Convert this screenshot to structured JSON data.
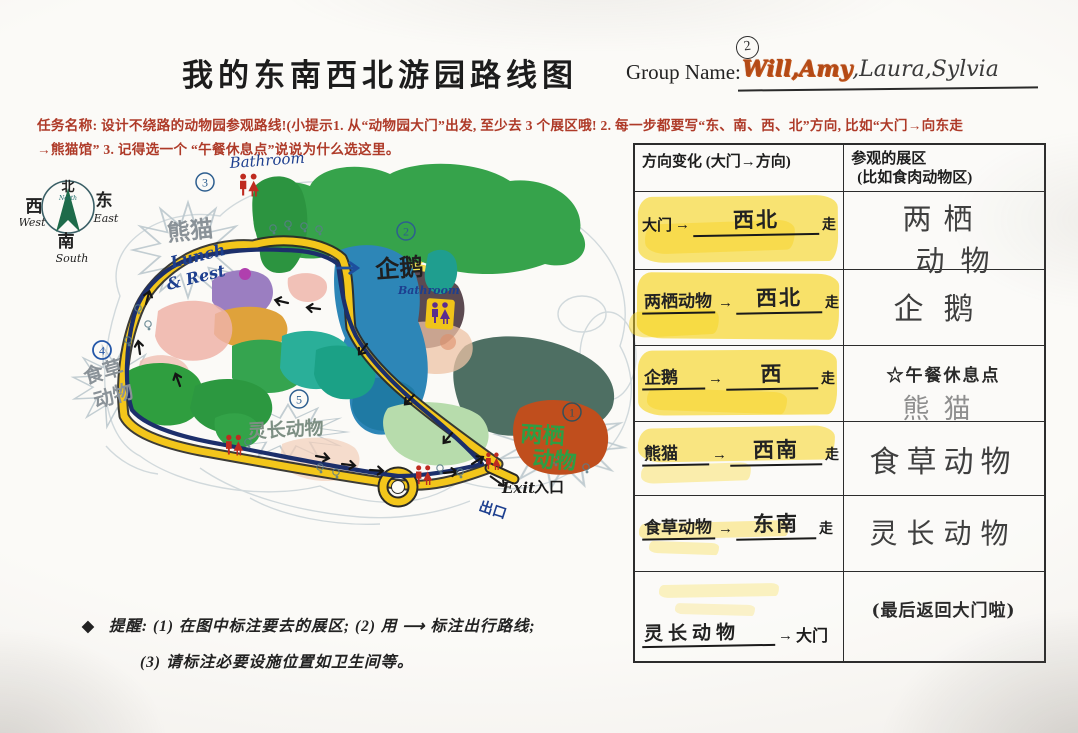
{
  "header": {
    "title": "我的东南西北游园路线图",
    "group_label": "Group Name:",
    "group_number": "2",
    "names_highlighted": "Will,Amy",
    "names_rest": ",Laura,Sylvia"
  },
  "task": {
    "line1": "任务名称: 设计不绕路的动物园参观路线!(小提示1. 从“动物园大门”出发, 至少去 3 个展区哦! 2.  每一步都要写“东、南、西、北”方向, 比如“大门→向东走",
    "line2": "→熊猫馆” 3. 记得选一个 “午餐休息点”说说为什么选这里。"
  },
  "map": {
    "compass": {
      "north": "北",
      "north_en": "North",
      "west": "西",
      "west_en": "West",
      "east": "东",
      "east_en": "East",
      "south": "南",
      "south_en": "South"
    },
    "markers": {
      "m1": "1",
      "m2": "2",
      "m3": "3",
      "m4": "4",
      "m5": "5"
    },
    "labels": {
      "bathroom_top": "Bathroom",
      "panda": "熊猫",
      "lunch1": "Lunch",
      "lunch2": "& Rest",
      "penguin": "企鹅",
      "bathroom_mid": "Bathroom",
      "amphibian1": "两栖",
      "amphibian2": "动物",
      "herbivore1": "食草",
      "herbivore2": "动物",
      "primate": "灵长动物",
      "exit_en": "Exit",
      "entrance_cn": "入口",
      "exit_cn": "出口"
    }
  },
  "table": {
    "header_left": "方向变化 (大门→方向)",
    "header_right_line1": "参观的展区",
    "header_right_line2": "(比如食肉动物区)",
    "arrow": "→",
    "rows": [
      {
        "from": "大门",
        "dir": "西北",
        "suffix": "走",
        "dest1": "两栖",
        "dest2": "动物"
      },
      {
        "from": "两栖动物",
        "dir": "西北",
        "suffix": "走",
        "dest1": "企鹅",
        "dest2": ""
      },
      {
        "from": "企鹅",
        "dir": "西",
        "suffix": "走",
        "dest1": "☆午餐休息点",
        "dest2": "熊猫"
      },
      {
        "from": "熊猫",
        "dir": "西南",
        "suffix": "走",
        "dest1": "食草动物",
        "dest2": ""
      },
      {
        "from": "食草动物",
        "dir": "东南",
        "suffix": "走",
        "dest1": "灵长动物",
        "dest2": ""
      },
      {
        "from": "灵长动物",
        "dir": "大门",
        "suffix": "",
        "dest1": "(最后返回大门啦)",
        "dest2": ""
      }
    ]
  },
  "footer": {
    "bullet": "◆",
    "line1": "提醒: (1) 在图中标注要去的展区; (2) 用 ⟶ 标注出行路线;",
    "line2": "(3) 请标注必要设施位置如卫生间等。"
  }
}
